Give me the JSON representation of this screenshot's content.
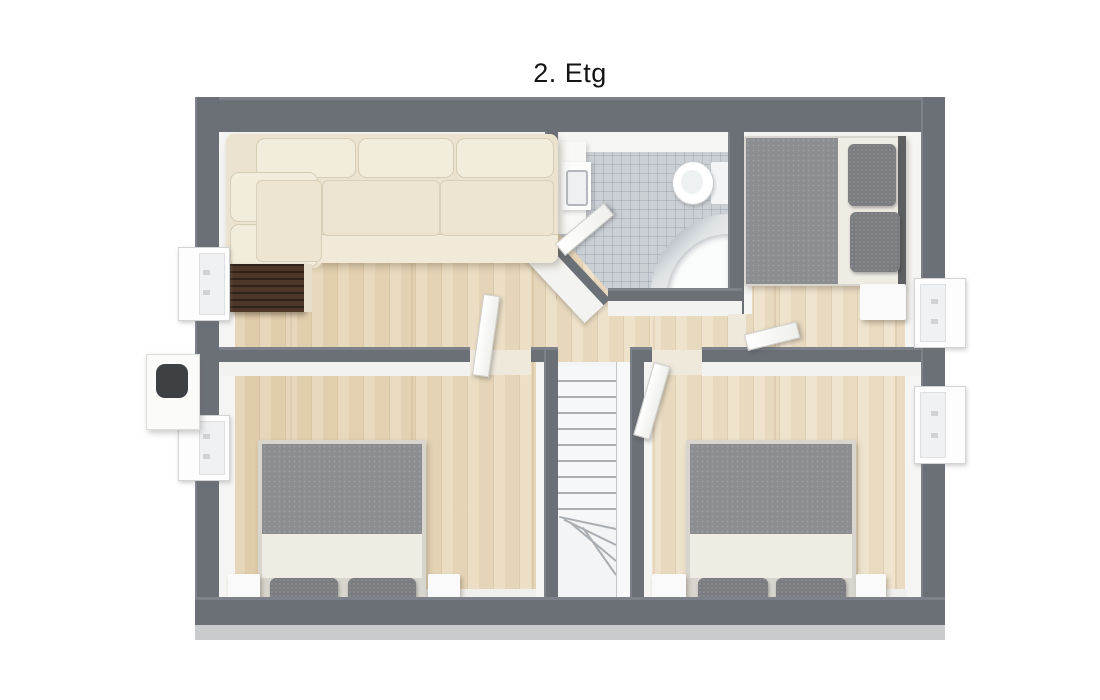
{
  "title": "2. Etg",
  "palette": {
    "wall": "#6b7077",
    "wallEdge": "#7d828a",
    "outerBand": "#c9cbcd",
    "innerFace": "#f5f5f3",
    "wood": "#e9d9ba",
    "tile": "#cbd0d5",
    "tileLine": "#a9b0b8",
    "white": "#fafafa",
    "cream": "#ebe3cf",
    "creamLight": "#f2ecdc",
    "creamLine": "#d6cdb6",
    "darkwood": "#4c3627",
    "duvet": "#8b8d90",
    "pillow": "#7a7c7f",
    "sheet": "#efece4",
    "headboard": "#5d5f61",
    "frame": "#d8d5ce",
    "stair": "#f3f4f5",
    "stairLine": "#a9aeb3",
    "vent": "#3e4144"
  },
  "floorplan": {
    "floor_label": "2. Etg",
    "rooms": [
      {
        "name": "living-room",
        "furniture": [
          "corner-sofa",
          "dark-wood-deck"
        ]
      },
      {
        "name": "bathroom",
        "furniture": [
          "vanity-sink",
          "toilet",
          "corner-bathtub"
        ]
      },
      {
        "name": "bedroom-upper-right",
        "furniture": [
          "double-bed",
          "nightstand"
        ]
      },
      {
        "name": "bedroom-lower-left",
        "furniture": [
          "double-bed",
          "nightstand-left",
          "nightstand-right"
        ]
      },
      {
        "name": "bedroom-lower-right",
        "furniture": [
          "double-bed",
          "nightstand-left",
          "nightstand-right"
        ]
      },
      {
        "name": "hallway",
        "furniture": []
      },
      {
        "name": "staircase",
        "furniture": [
          "winder-stairs"
        ]
      }
    ],
    "window_count": 4,
    "door_count": 4,
    "chimney_count": 1
  }
}
